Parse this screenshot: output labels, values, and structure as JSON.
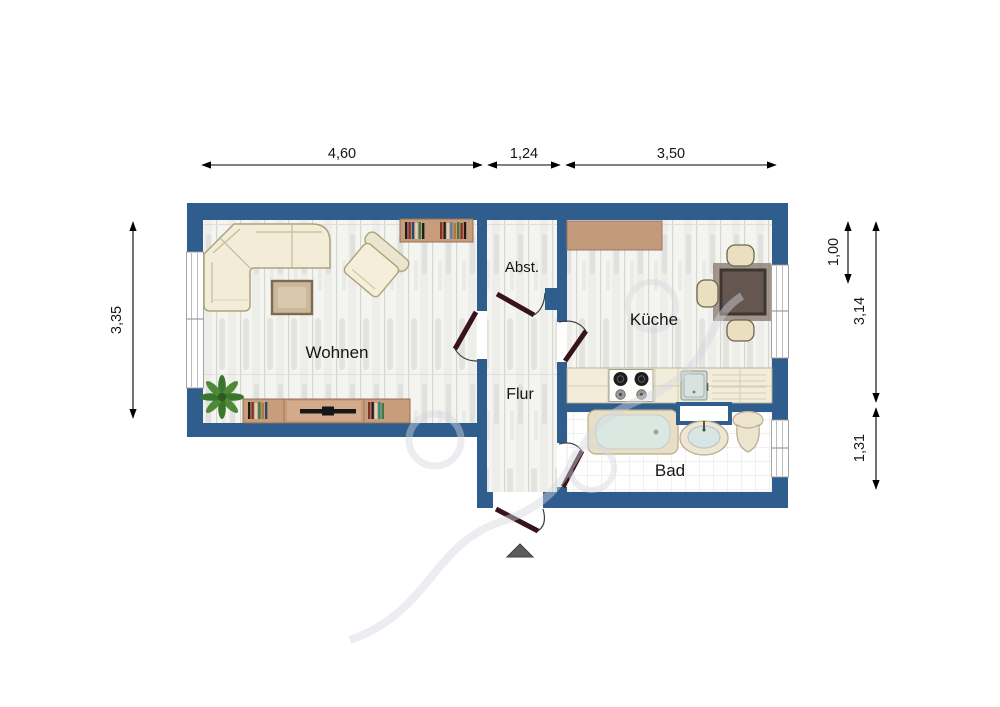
{
  "rooms": {
    "wohnen": {
      "label": "Wohnen"
    },
    "abstellraum": {
      "label": "Abst."
    },
    "flur": {
      "label": "Flur"
    },
    "kueche": {
      "label": "Küche"
    },
    "bad": {
      "label": "Bad"
    }
  },
  "dimensions": {
    "top": [
      {
        "value": "4,60"
      },
      {
        "value": "1,24"
      },
      {
        "value": "3,50"
      }
    ],
    "left": [
      {
        "value": "3,35"
      }
    ],
    "right": [
      {
        "value": "1,00"
      },
      {
        "value": "3,14"
      },
      {
        "value": "1,31"
      }
    ]
  },
  "colors": {
    "wall": "#2e5d8e",
    "door_leaf": "#38131c",
    "entrance_arrow": "#5c5c5c",
    "furniture_wood": "#c79d7c",
    "upholstery": "#f2ecd8",
    "dining_table": "#655750",
    "water": "#d9e9e2",
    "plant": "#39752c",
    "dimension_text": "#161616"
  },
  "icons": {
    "entrance_arrow": "entrance-arrow-icon"
  },
  "furniture": [
    "corner-sofa",
    "armchair",
    "coffee-table",
    "wall-bookshelf",
    "tv-sideboard",
    "plant",
    "kitchen-wall-cabinet",
    "kitchen-counter",
    "stove",
    "kitchen-sink",
    "dining-table",
    "dining-chair",
    "bathtub",
    "mirror-shelf",
    "washbasin",
    "toilet"
  ]
}
